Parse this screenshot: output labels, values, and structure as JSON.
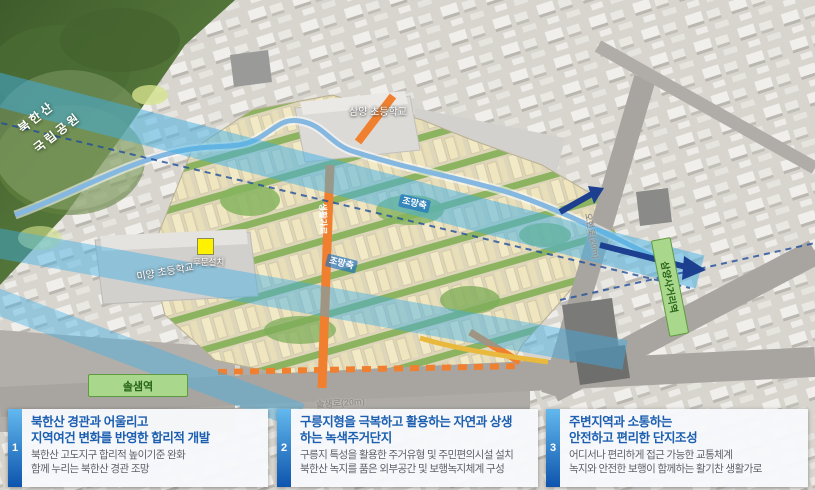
{
  "map": {
    "park_label": {
      "line1": "북한산",
      "line2": "국립공원"
    },
    "labels": {
      "school_top": "삼양 초등학교",
      "school_left": "미양 초등학교",
      "gate_marker": "후문설치",
      "station_left": "솔샘역",
      "station_right": "삼양사거리역",
      "view_axis_upper": "조망축",
      "view_axis_lower": "조망축",
      "road_bottom": "솔샘로(20m)",
      "road_right": "오현로(20m)",
      "road_orange": "생활가로"
    },
    "colors": {
      "view_band_blue": "#3fb0e6",
      "navy_arrow": "#1c3f8f",
      "stream_blue": "#85b8e0",
      "orange_road": "#f08030",
      "park_green": "#4e6f36",
      "station_green": "#a9d78c",
      "site_cream": "#efe5bf"
    }
  },
  "panels": [
    {
      "number": "1",
      "title_line1": "북한산 경관과 어울리고",
      "title_line2": "지역여건 변화를 반영한 합리적 개발",
      "body_line1": "북한산 고도지구 합리적 높이기준 완화",
      "body_line2": "함께 누리는 북한산 경관 조망"
    },
    {
      "number": "2",
      "title_line1": "구릉지형을 극복하고 활용하는 자연과 상생",
      "title_line2": "하는 녹색주거단지",
      "body_line1": "구릉지 특성을 활용한 주거유형 및 주민편의시설 설치",
      "body_line2": "북한산 녹지를 품은 외부공간 및 보행녹지체계 구성"
    },
    {
      "number": "3",
      "title_line1": "주변지역과 소통하는",
      "title_line2": "안전하고 편리한 단지조성",
      "body_line1": "어디서나 편리하게 접근 가능한 교통체계",
      "body_line2": "녹지와 안전한 보행이 함께하는 활기찬 생활가로"
    }
  ]
}
